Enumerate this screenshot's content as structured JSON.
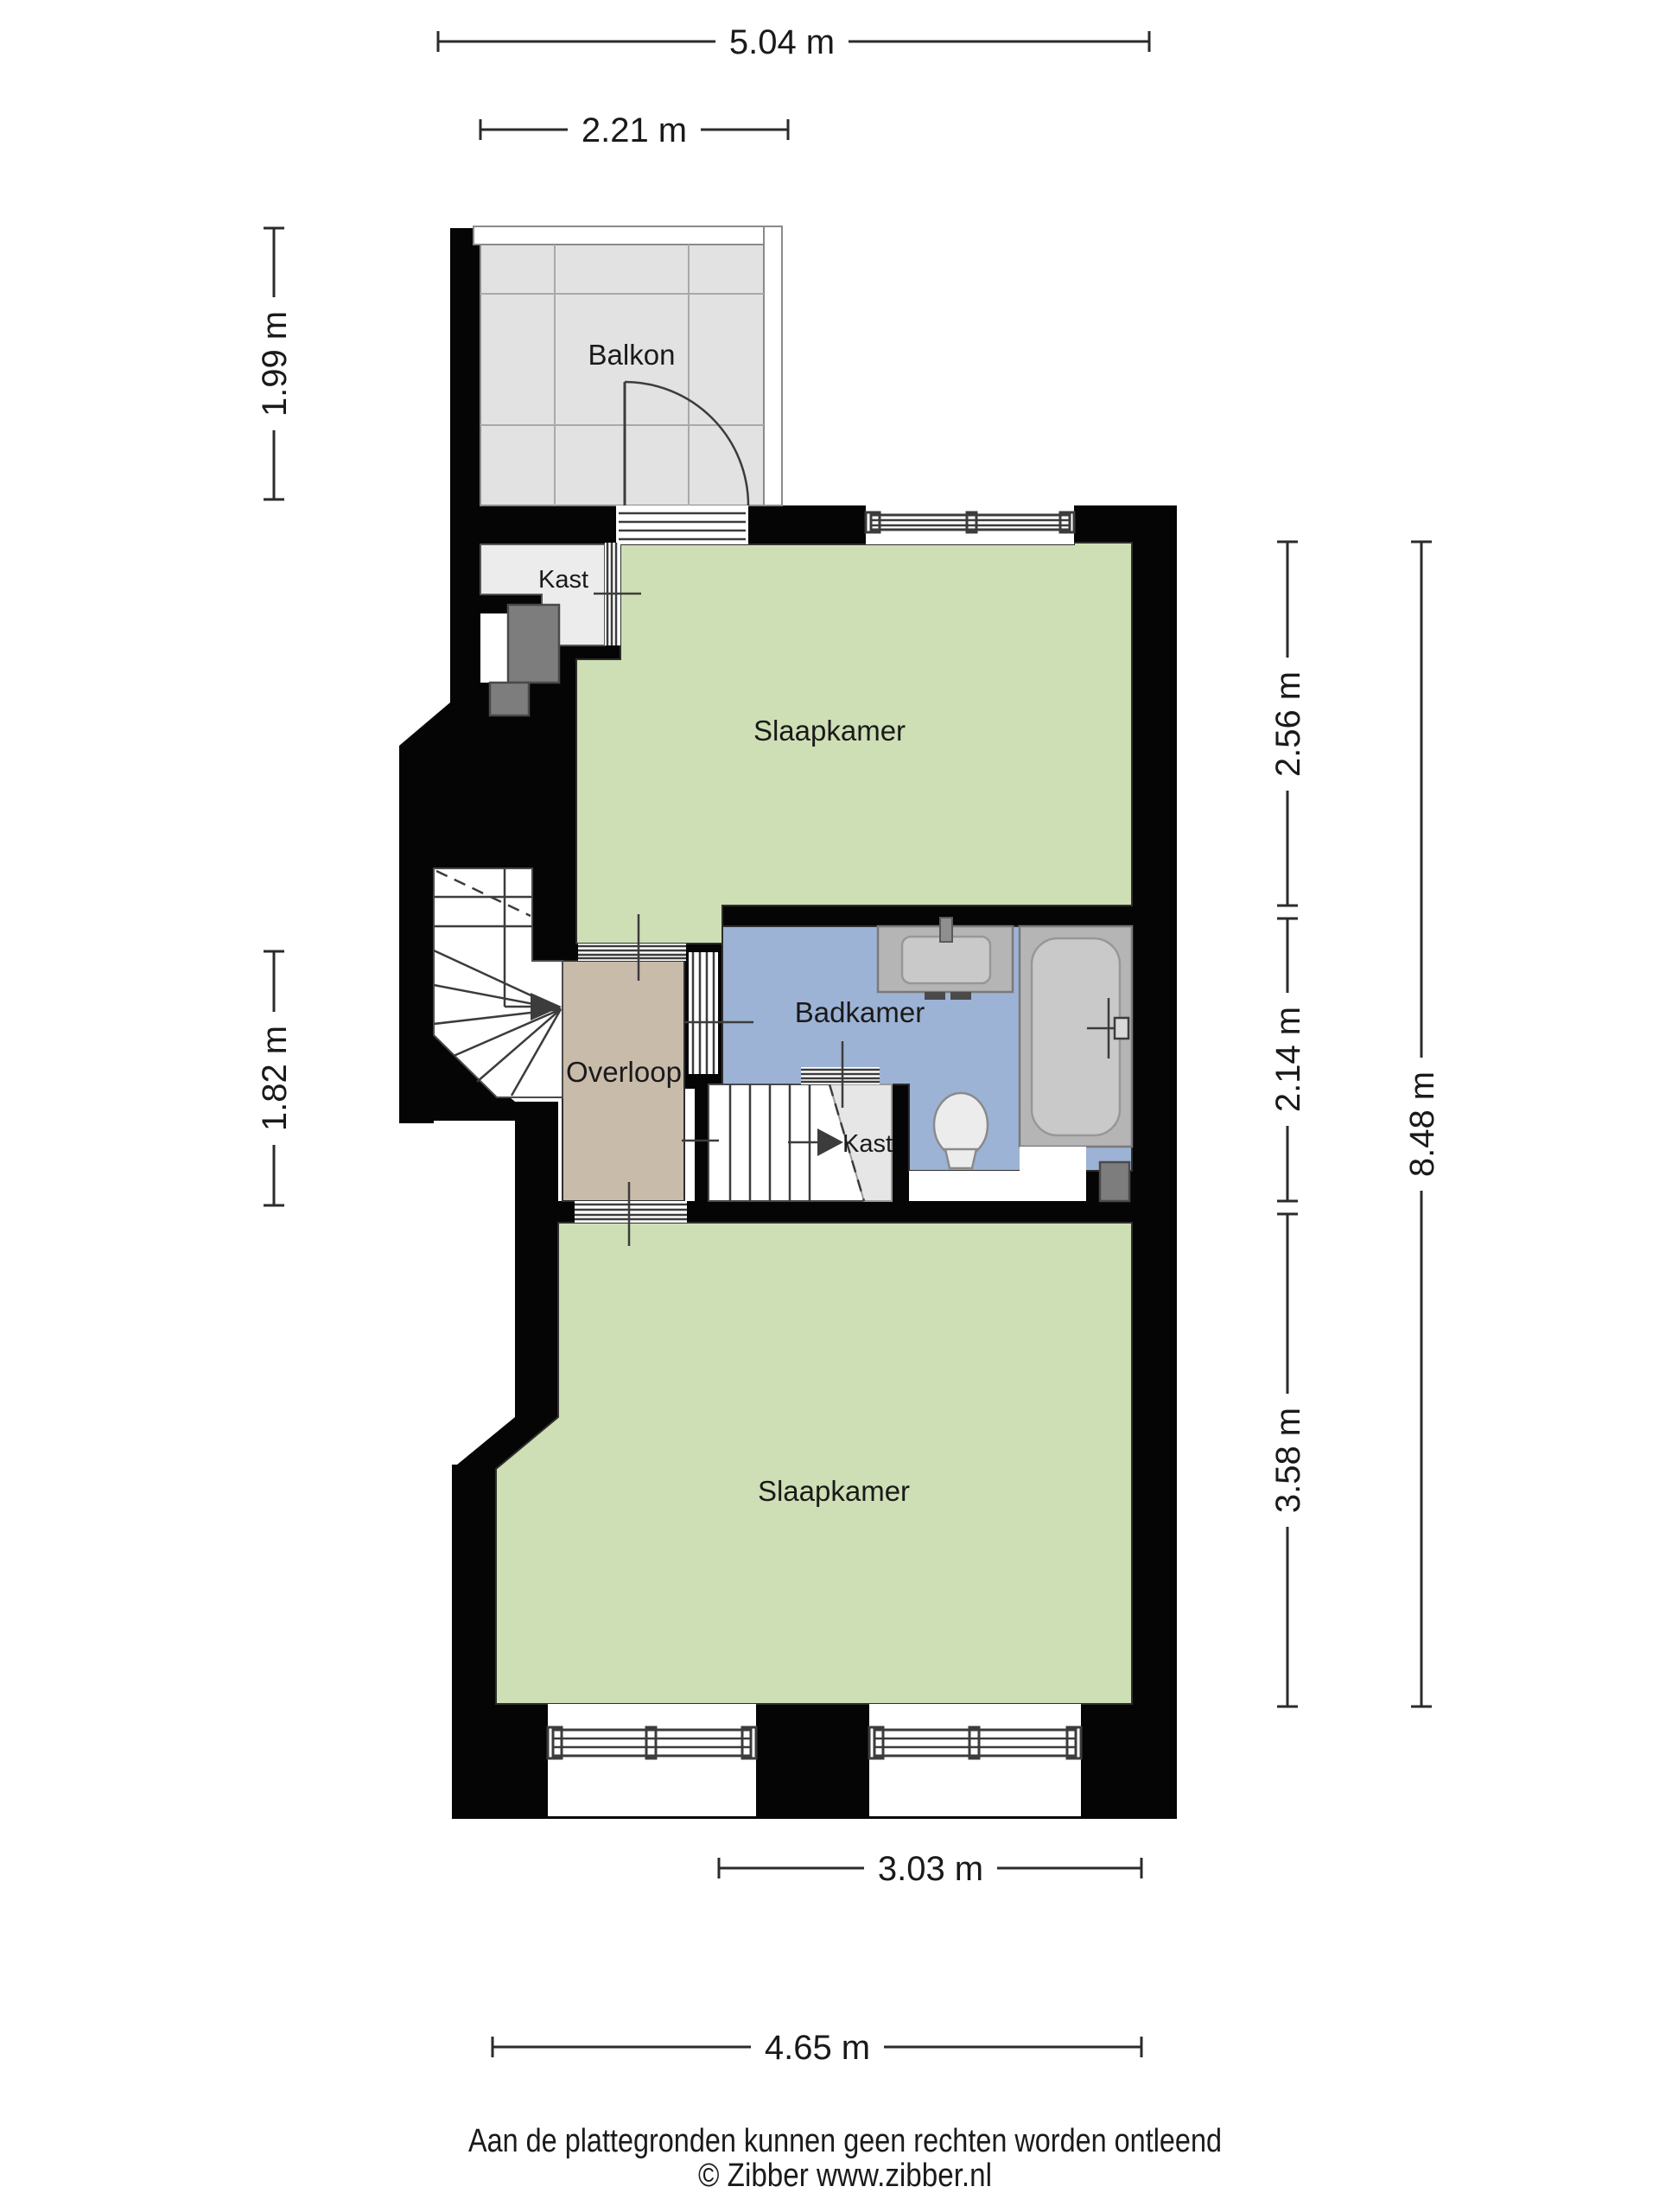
{
  "rooms": {
    "balcony": {
      "label": "Balkon"
    },
    "closet_top": {
      "label": "Kast"
    },
    "bedroom_top": {
      "label": "Slaapkamer"
    },
    "landing": {
      "label": "Overloop"
    },
    "bathroom": {
      "label": "Badkamer"
    },
    "closet_middle": {
      "label": "Kast"
    },
    "bedroom_bottom": {
      "label": "Slaapkamer"
    }
  },
  "dimensions": {
    "width_total": {
      "label": "5.04 m",
      "value": 5.04,
      "unit": "m",
      "orientation": "horizontal"
    },
    "width_balcony": {
      "label": "2.21 m",
      "value": 2.21,
      "unit": "m",
      "orientation": "horizontal"
    },
    "height_balcony": {
      "label": "1.99 m",
      "value": 1.99,
      "unit": "m",
      "orientation": "vertical"
    },
    "height_landing": {
      "label": "1.82 m",
      "value": 1.82,
      "unit": "m",
      "orientation": "vertical"
    },
    "height_bedroom_top": {
      "label": "2.56 m",
      "value": 2.56,
      "unit": "m",
      "orientation": "vertical"
    },
    "height_bathroom": {
      "label": "2.14 m",
      "value": 2.14,
      "unit": "m",
      "orientation": "vertical"
    },
    "height_bedroom_bottom": {
      "label": "3.58 m",
      "value": 3.58,
      "unit": "m",
      "orientation": "vertical"
    },
    "height_total": {
      "label": "8.48 m",
      "value": 8.48,
      "unit": "m",
      "orientation": "vertical"
    },
    "width_bedroom_inner": {
      "label": "3.03 m",
      "value": 3.03,
      "unit": "m",
      "orientation": "horizontal"
    },
    "width_bedroom_outer": {
      "label": "4.65 m",
      "value": 4.65,
      "unit": "m",
      "orientation": "horizontal"
    }
  },
  "footer": {
    "disclaimer": "Aan de plattegronden kunnen geen rechten worden ontleend",
    "copyright": "© Zibber www.zibber.nl"
  },
  "colors": {
    "wall": "#050505",
    "bedroom_floor": "#cfdfb5",
    "bathroom_floor": "#9db3d5",
    "landing_floor": "#c9bbaa",
    "balcony_floor": "#e2e2e2",
    "closet_floor": "#ececec",
    "shaft": "#7d7d7d",
    "fixture": "#b5b5b5",
    "text": "#1a1a1a"
  }
}
